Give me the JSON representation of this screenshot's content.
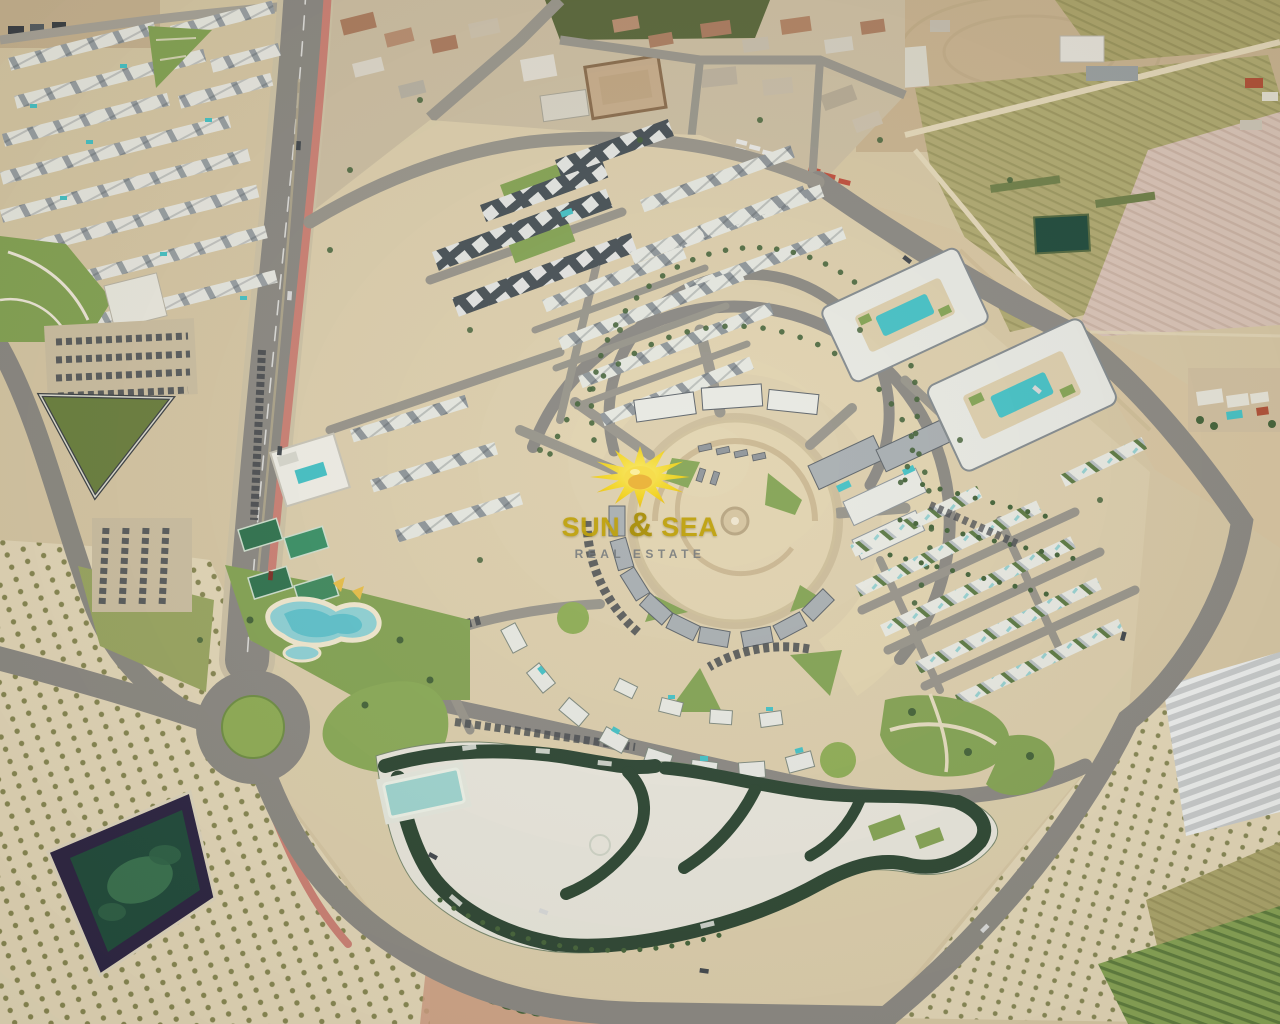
{
  "watermark": {
    "title_sun": "SUN",
    "title_amp": "&",
    "title_sea": "SEA",
    "subtitle": "REAL ESTATE"
  },
  "colors": {
    "sand": "#d7c8a6",
    "sandLight": "#e4d8ba",
    "sandDev": "#ddcfae",
    "sandPlaza": "#e2d4b1",
    "road": "#8b8984",
    "roadMinor": "#98958c",
    "sidewalk": "#cfc4a8",
    "bikeLane": "#cd8176",
    "lawn": "#84a455",
    "lawnBright": "#8fae57",
    "lawnDark": "#5d7c3c",
    "court": "#2f7350",
    "pool": "#45c2c7",
    "poolLight": "#9fd6d2",
    "roofWhite": "#e9eae5",
    "roofGray": "#a9afb3",
    "roofDark": "#475057",
    "resortRoof": "#2c4634",
    "resortCourt": "#eae8df",
    "pondEdge": "#2a2343",
    "pondWater": "#1e4a3c",
    "pondAlgae": "#3e7a55",
    "orchard": "#82834e",
    "fieldOlive": "#aca56c",
    "fieldTan": "#c9b391",
    "fieldPink": "#d9c4b8",
    "fieldPale": "#e7dcc6",
    "vineyard": "#86a355",
    "greenhouse": "#c9ccce",
    "village": "#cdbfa4",
    "roofBrown": "#ac7c60",
    "roofRed": "#b05038",
    "treeDark": "#44633a",
    "carDark": "#41474e",
    "gold": "#bfa20c",
    "goldDeep": "#a88f07",
    "grayText": "#73787c",
    "sunYellow": "#f2d320",
    "sunDeep": "#e9ae3c"
  }
}
